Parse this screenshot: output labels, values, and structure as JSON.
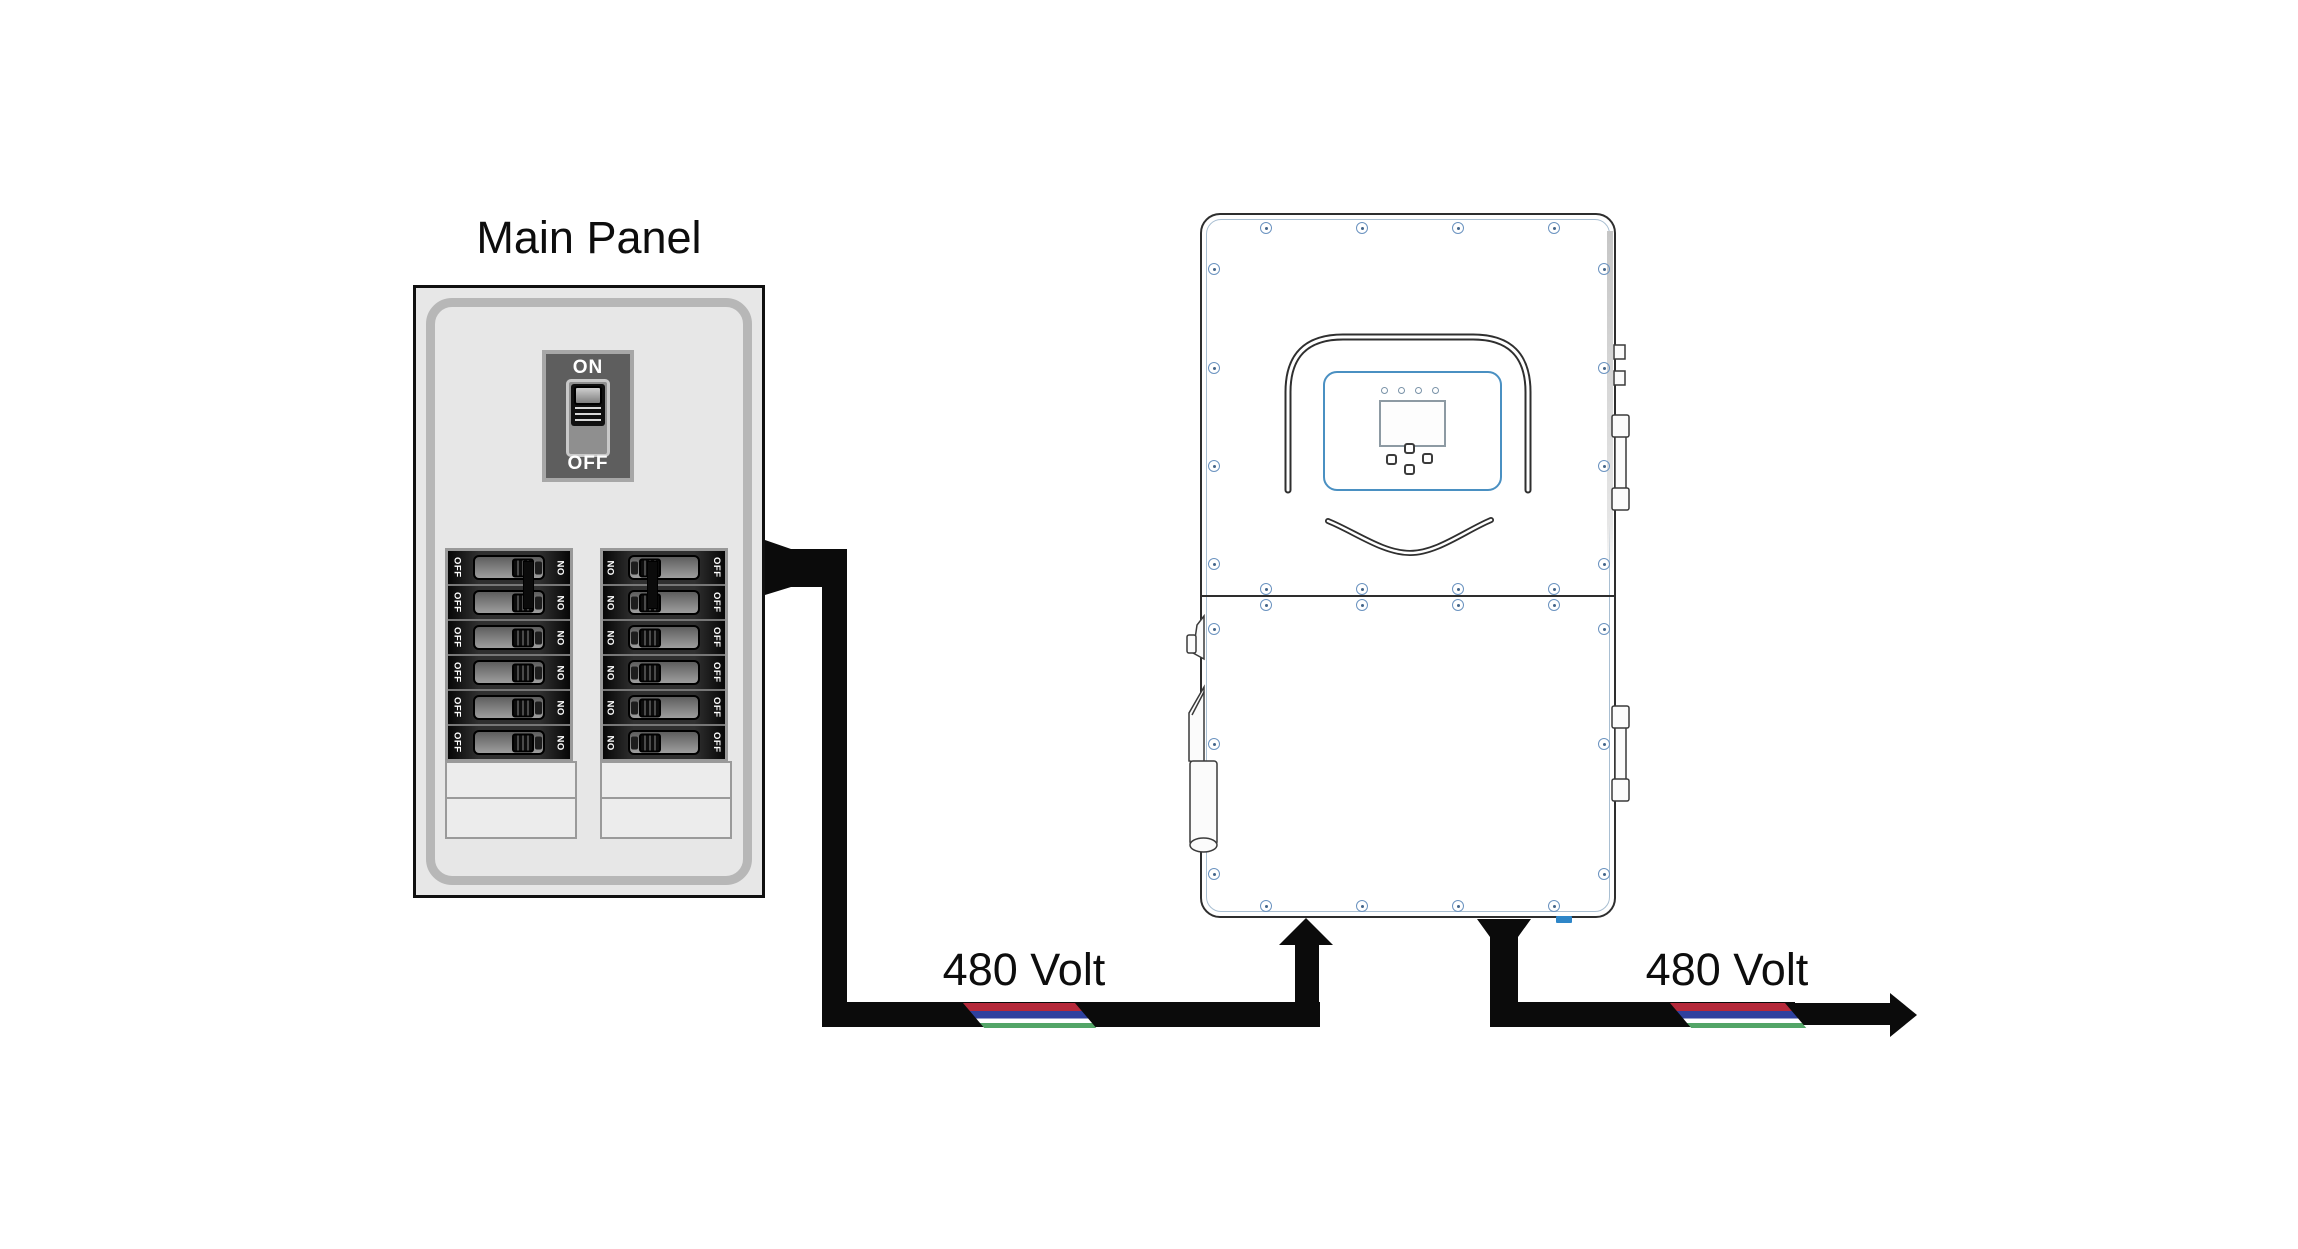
{
  "title": "Main Panel",
  "main_switch": {
    "on_label": "ON",
    "off_label": "OFF"
  },
  "breaker_panel": {
    "columns": [
      {
        "name": "left",
        "left_label": "OFF",
        "right_label": "ON",
        "lever_side": "right",
        "breaker_count": 6,
        "tied_pair": true
      },
      {
        "name": "right",
        "left_label": "ON",
        "right_label": "OFF",
        "lever_side": "left",
        "breaker_count": 6,
        "tied_pair": true
      }
    ],
    "blank_slot_rows": 2
  },
  "cables": {
    "input": {
      "label": "480 Volt"
    },
    "output": {
      "label": "480 Volt"
    },
    "stripe_colors": [
      "#b5293a",
      "#2f419e",
      "#ffffff",
      "#53a567"
    ]
  },
  "inverter": {
    "led_count": 4
  },
  "colors": {
    "cable": "#0b0b0b",
    "screw": "#6b93c0",
    "display_bezel": "#4a90c2",
    "connector": "#2e86c8"
  }
}
